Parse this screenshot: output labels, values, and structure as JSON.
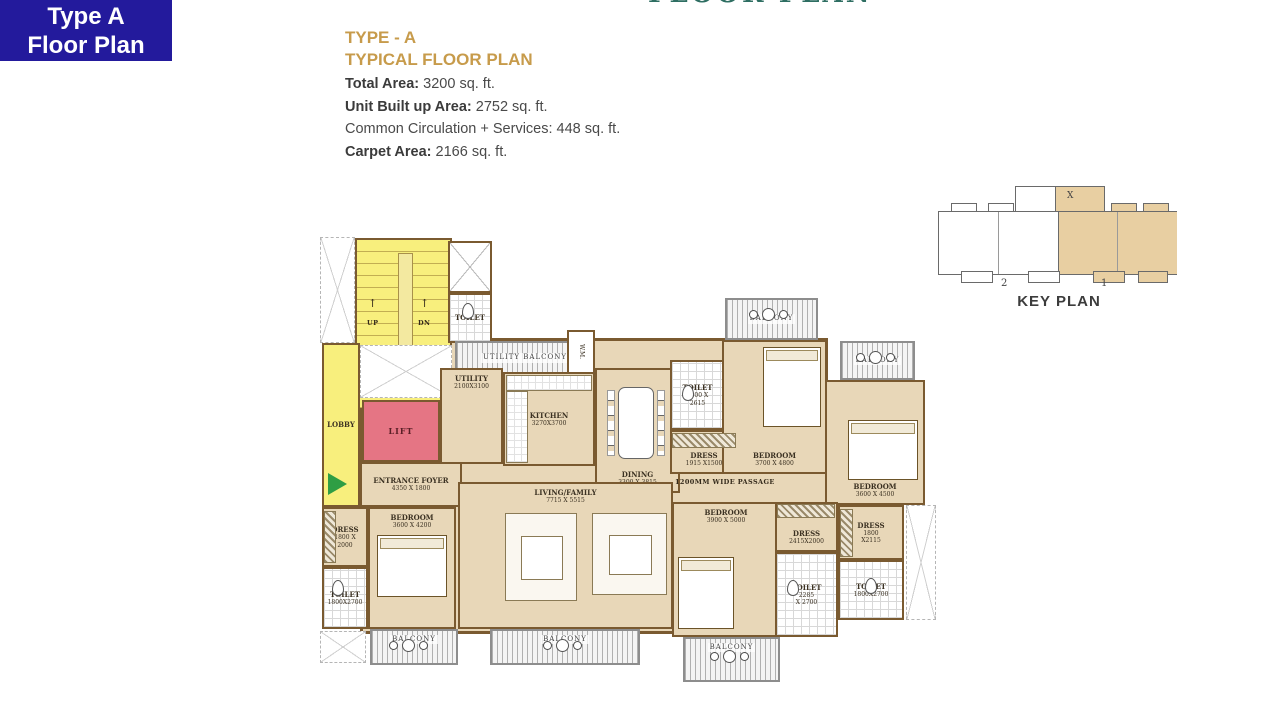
{
  "badge": {
    "line1": "Type A",
    "line2": "Floor Plan"
  },
  "top_clipped_title": "FLOOR PLAN",
  "title": {
    "line1": "TYPE - A",
    "line2": "TYPICAL FLOOR PLAN"
  },
  "stats": [
    {
      "label": "Total Area:",
      "value": " 3200 sq. ft.",
      "bold": true
    },
    {
      "label": "Unit Built up Area:",
      "value": " 2752 sq. ft.",
      "bold": true
    },
    {
      "label": "Common Circulation + Services:",
      "value": " 448 sq. ft.",
      "bold": false
    },
    {
      "label": "Carpet Area:",
      "value": " 2166 sq. ft.",
      "bold": true
    }
  ],
  "key_plan": {
    "title": "KEY PLAN",
    "marker": "X",
    "labels": [
      "2",
      "1"
    ]
  },
  "colors": {
    "badge_bg": "#231a9c",
    "title_gold": "#c79b4b",
    "plan_tan": "#e8d7b8",
    "wall_brown": "#7a5a30",
    "stair_yellow": "#f8ef7d",
    "lift_pink": "#e57584",
    "entry_green": "#2f9e44",
    "keyplan_tan": "#e8cfa2",
    "clip_teal": "#2e6e62"
  },
  "plan": {
    "rooms": [
      {
        "id": "unit-slab",
        "type": "slab",
        "x": 40,
        "y": 103,
        "w": 468,
        "h": 296
      },
      {
        "id": "void-top-left",
        "type": "void",
        "x": 0,
        "y": 2,
        "w": 35,
        "h": 106
      },
      {
        "id": "stairs",
        "type": "stairs",
        "x": 35,
        "y": 3,
        "w": 97,
        "h": 172
      },
      {
        "id": "lift-shaft",
        "type": "shaft",
        "x": 128,
        "y": 6,
        "w": 44,
        "h": 52
      },
      {
        "id": "toilet-top",
        "name": "TOILET",
        "type": "toilet",
        "x": 128,
        "y": 58,
        "w": 44,
        "h": 50
      },
      {
        "id": "lobby",
        "name": "LOBBY",
        "type": "yellow",
        "x": 2,
        "y": 108,
        "w": 38,
        "h": 164
      },
      {
        "id": "void-mid",
        "type": "void",
        "x": 40,
        "y": 110,
        "w": 92,
        "h": 53
      },
      {
        "id": "lift",
        "name": "LIFT",
        "type": "lift",
        "x": 42,
        "y": 165,
        "w": 78,
        "h": 62
      },
      {
        "id": "utility-balcony",
        "name": "UTILITY BALCONY",
        "type": "balcony",
        "x": 135,
        "y": 106,
        "w": 140,
        "h": 34
      },
      {
        "id": "wm",
        "name": "W.M.",
        "type": "wm",
        "x": 247,
        "y": 95,
        "w": 28,
        "h": 44
      },
      {
        "id": "utility",
        "name": "UTILITY",
        "dims": "2100X3100",
        "type": "room",
        "lpos": "top",
        "x": 120,
        "y": 133,
        "w": 63,
        "h": 96
      },
      {
        "id": "kitchen",
        "name": "KITCHEN",
        "dims": "3270X3700",
        "type": "room",
        "x": 183,
        "y": 137,
        "w": 92,
        "h": 94
      },
      {
        "id": "dining",
        "name": "DINING",
        "dims": "3300 X 3815",
        "type": "room",
        "lpos": "bottom",
        "x": 275,
        "y": 133,
        "w": 85,
        "h": 125
      },
      {
        "id": "entrance-foyer",
        "name": "ENTRANCE FOYER",
        "dims": "4350 X 1800",
        "type": "room",
        "x": 40,
        "y": 227,
        "w": 102,
        "h": 45
      },
      {
        "id": "dress-left",
        "name": "DRESS",
        "dims": "1800 X\n2000",
        "type": "room",
        "x": 2,
        "y": 272,
        "w": 46,
        "h": 60
      },
      {
        "id": "toilet-bottom-left",
        "name": "TOILET",
        "dims": "1800X2700",
        "type": "toilet",
        "x": 2,
        "y": 332,
        "w": 46,
        "h": 62
      },
      {
        "id": "bedroom-1",
        "name": "BEDROOM",
        "dims": "3600 X 4200",
        "type": "room",
        "lpos": "top",
        "x": 48,
        "y": 272,
        "w": 88,
        "h": 122
      },
      {
        "id": "balcony-bottom-left",
        "name": "BALCONY",
        "type": "balcony",
        "lpos": "top",
        "x": 50,
        "y": 394,
        "w": 88,
        "h": 36
      },
      {
        "id": "living-family",
        "name": "LIVING/FAMILY",
        "dims": "7715 X 5515",
        "type": "room",
        "lpos": "top",
        "x": 138,
        "y": 247,
        "w": 215,
        "h": 147
      },
      {
        "id": "balcony-bottom-center",
        "name": "BALCONY",
        "type": "balcony",
        "lpos": "top",
        "x": 170,
        "y": 394,
        "w": 150,
        "h": 36
      },
      {
        "id": "toilet-mid",
        "name": "TOILET",
        "dims": "1800 X\n2615",
        "type": "toilet",
        "x": 350,
        "y": 125,
        "w": 55,
        "h": 70
      },
      {
        "id": "dress-mid",
        "name": "DRESS",
        "dims": "1915 X1500",
        "type": "room",
        "lpos": "bottom",
        "x": 350,
        "y": 195,
        "w": 68,
        "h": 44
      },
      {
        "id": "bedroom-2",
        "name": "BEDROOM",
        "dims": "3700 X 4800",
        "type": "room",
        "lpos": "bottom",
        "x": 402,
        "y": 105,
        "w": 105,
        "h": 134
      },
      {
        "id": "balcony-top-1",
        "name": "BALCONY",
        "type": "balcony",
        "x": 405,
        "y": 63,
        "w": 93,
        "h": 42
      },
      {
        "id": "bedroom-3",
        "name": "BEDROOM",
        "dims": "3600 X 4500",
        "type": "room",
        "lpos": "bottom",
        "x": 505,
        "y": 145,
        "w": 100,
        "h": 125
      },
      {
        "id": "balcony-top-2",
        "name": "BALCONY",
        "type": "balcony",
        "x": 520,
        "y": 106,
        "w": 75,
        "h": 39
      },
      {
        "id": "bedroom-4",
        "name": "BEDROOM",
        "dims": "3900 X 5000",
        "type": "room",
        "lpos": "top",
        "x": 352,
        "y": 267,
        "w": 108,
        "h": 135
      },
      {
        "id": "dress-4",
        "name": "DRESS",
        "dims": "2415X2000",
        "type": "room",
        "lpos": "bottom",
        "x": 455,
        "y": 267,
        "w": 63,
        "h": 50
      },
      {
        "id": "toilet-br-1",
        "name": "TOILET",
        "dims": "2285\nX 2700",
        "type": "toilet",
        "x": 455,
        "y": 317,
        "w": 63,
        "h": 85
      },
      {
        "id": "dress-3",
        "name": "DRESS",
        "dims": "1800\nX2115",
        "type": "room",
        "x": 518,
        "y": 270,
        "w": 66,
        "h": 55
      },
      {
        "id": "toilet-br-2",
        "name": "TOILET",
        "dims": "1800X2700",
        "type": "toilet",
        "x": 518,
        "y": 325,
        "w": 66,
        "h": 60
      },
      {
        "id": "void-bottom-left",
        "type": "void",
        "x": 0,
        "y": 396,
        "w": 46,
        "h": 32
      },
      {
        "id": "void-bottom-right",
        "type": "void",
        "x": 586,
        "y": 270,
        "w": 30,
        "h": 115
      },
      {
        "id": "balcony-bottom-4",
        "name": "BALCONY",
        "type": "balcony",
        "lpos": "top",
        "x": 363,
        "y": 402,
        "w": 97,
        "h": 45
      }
    ],
    "texts": [
      {
        "label": "↑",
        "x": 48,
        "y": 62,
        "cls": "arrow"
      },
      {
        "label": "UP",
        "x": 47,
        "y": 84
      },
      {
        "label": "↑",
        "x": 100,
        "y": 62,
        "cls": "arrow"
      },
      {
        "label": "DN",
        "x": 98,
        "y": 84
      },
      {
        "label": "1200MM WIDE PASSAGE",
        "x": 355,
        "y": 243
      }
    ],
    "furniture": [
      {
        "kind": "wc",
        "x": 142,
        "y": 68,
        "w": 12,
        "h": 16
      },
      {
        "kind": "wc",
        "x": 12,
        "y": 345,
        "w": 12,
        "h": 16
      },
      {
        "kind": "wc",
        "x": 362,
        "y": 150,
        "w": 12,
        "h": 16
      },
      {
        "kind": "wc",
        "x": 467,
        "y": 345,
        "w": 12,
        "h": 16
      },
      {
        "kind": "wc",
        "x": 545,
        "y": 343,
        "w": 12,
        "h": 16
      },
      {
        "kind": "counter",
        "x": 186,
        "y": 140,
        "w": 86,
        "h": 16
      },
      {
        "kind": "counter",
        "x": 186,
        "y": 156,
        "w": 22,
        "h": 72
      },
      {
        "kind": "dtable",
        "x": 298,
        "y": 152,
        "w": 36,
        "h": 72
      },
      {
        "kind": "chaircol",
        "x": 287,
        "y": 155,
        "w": 8,
        "h": 66
      },
      {
        "kind": "chaircol",
        "x": 337,
        "y": 155,
        "w": 8,
        "h": 66
      },
      {
        "kind": "bed",
        "x": 57,
        "y": 300,
        "w": 70,
        "h": 62
      },
      {
        "kind": "bed",
        "x": 443,
        "y": 112,
        "w": 58,
        "h": 80
      },
      {
        "kind": "bed",
        "x": 528,
        "y": 185,
        "w": 70,
        "h": 60
      },
      {
        "kind": "bed",
        "x": 358,
        "y": 322,
        "w": 56,
        "h": 72
      },
      {
        "kind": "sofa",
        "x": 185,
        "y": 278,
        "w": 72,
        "h": 88
      },
      {
        "kind": "sofa",
        "x": 272,
        "y": 278,
        "w": 75,
        "h": 82
      },
      {
        "kind": "btable",
        "x": 82,
        "y": 404,
        "w": 13,
        "h": 13
      },
      {
        "kind": "btable",
        "x": 236,
        "y": 404,
        "w": 13,
        "h": 13
      },
      {
        "kind": "btable",
        "x": 442,
        "y": 73,
        "w": 13,
        "h": 13
      },
      {
        "kind": "btable",
        "x": 549,
        "y": 116,
        "w": 13,
        "h": 13
      },
      {
        "kind": "btable",
        "x": 403,
        "y": 415,
        "w": 13,
        "h": 13
      },
      {
        "kind": "ward",
        "x": 4,
        "y": 276,
        "w": 12,
        "h": 52
      },
      {
        "kind": "ward",
        "x": 352,
        "y": 198,
        "w": 64,
        "h": 15
      },
      {
        "kind": "ward",
        "x": 520,
        "y": 274,
        "w": 13,
        "h": 48
      },
      {
        "kind": "ward",
        "x": 457,
        "y": 269,
        "w": 58,
        "h": 14
      },
      {
        "kind": "entry",
        "x": 8,
        "y": 238,
        "w": 0,
        "h": 0
      }
    ]
  }
}
